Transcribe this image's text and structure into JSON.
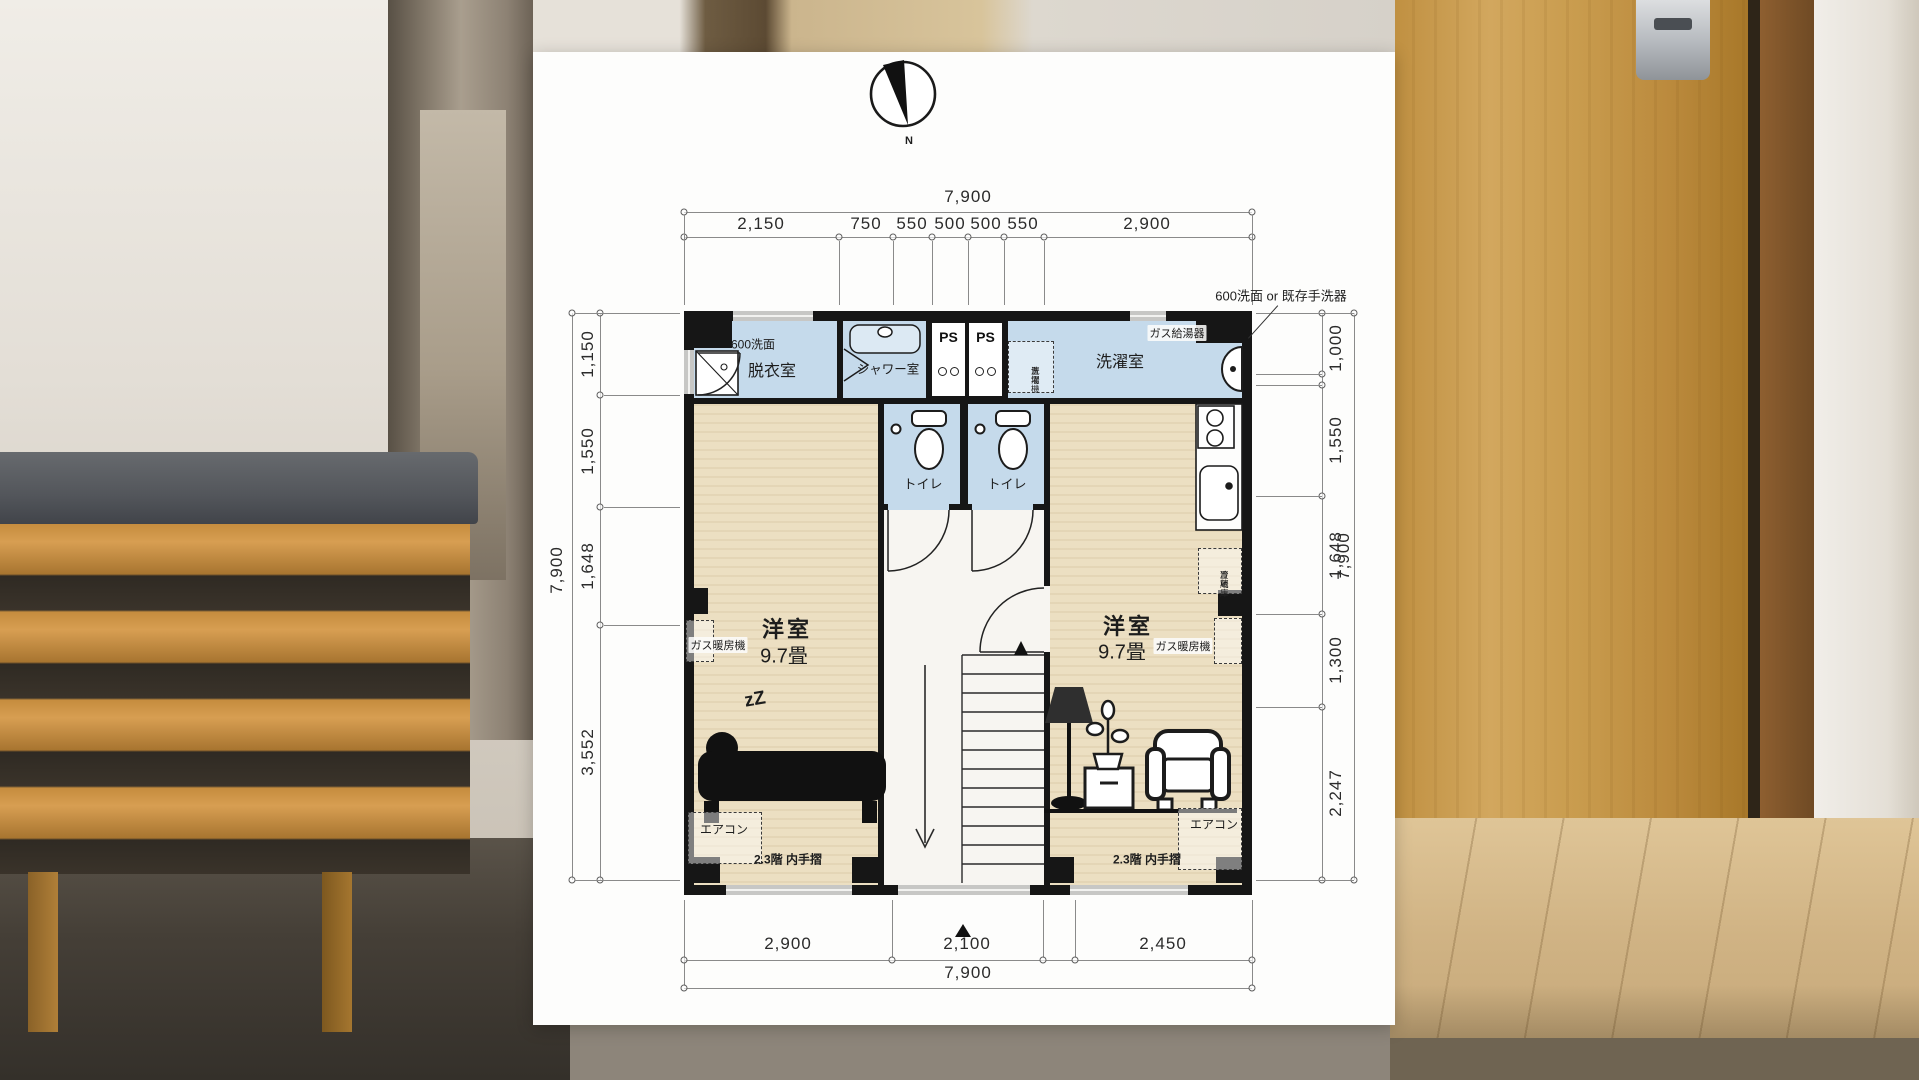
{
  "compass": {
    "north_label": "N"
  },
  "colors": {
    "wet_room": "#c5daeb",
    "bedroom": "#ecdfc2",
    "wall": "#161616"
  },
  "dims": {
    "top": {
      "total": "7,900",
      "segments": [
        "2,150",
        "750",
        "550",
        "500",
        "500",
        "550",
        "2,900"
      ]
    },
    "bottom": {
      "total": "7,900",
      "segments": [
        "2,900",
        "2,100",
        "2,450"
      ]
    },
    "left": {
      "total": "7,900",
      "segments": [
        "1,150",
        "1,550",
        "1,648",
        "3,552"
      ]
    },
    "right": {
      "total": "7,900",
      "segments": [
        "1,000",
        "1,550",
        "1,648",
        "1,300",
        "2,247"
      ]
    }
  },
  "rooms": {
    "dressing": "脱衣室",
    "shower": "シャワー室",
    "laundry": "洗濯室",
    "ps_left": "PS",
    "ps_right": "PS",
    "toilet_left": "トイレ",
    "toilet_right": "トイレ",
    "west_left_name": "洋室",
    "west_left_size": "9.7畳",
    "west_right_name": "洋室",
    "west_right_size": "9.7畳"
  },
  "labels": {
    "sink600": "600洗面",
    "sink_note": "600洗面 or 既存手洗器",
    "gas_water_heater": "ガス給湯器",
    "gas_heater_left": "ガス暖房機",
    "gas_heater_right": "ガス暖房機",
    "washer_line1": "洗濯機",
    "washer_line2": "置場",
    "fridge_line1": "冷蔵庫",
    "fridge_line2": "置場",
    "aircon_left": "エアコン",
    "aircon_right": "エアコン",
    "handrail_left": "2.3階 内手摺",
    "handrail_right": "2.3階 内手摺",
    "sleep": "zZ"
  }
}
